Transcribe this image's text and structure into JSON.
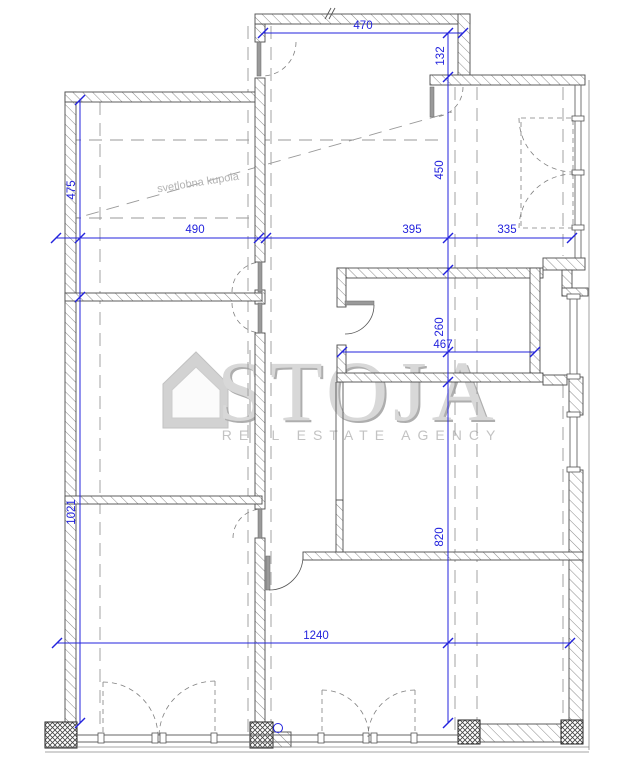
{
  "plan": {
    "type": "architectural-floor-plan",
    "skylight_label": "svetlobna kupola",
    "watermark": {
      "brand": "STOJA",
      "tagline": "REAL ESTATE AGENCY"
    },
    "dimensions": {
      "d470": "470",
      "d132": "132",
      "d475": "475",
      "d490": "490",
      "d395": "395",
      "d335": "335",
      "d450": "450",
      "d260": "260",
      "d467": "467",
      "d1021": "1021",
      "d820": "820",
      "d1240": "1240"
    },
    "colors": {
      "dimension_blue": "#2323dd",
      "wall_line": "#4d4d4d",
      "dashed_gray": "#9a9a9a",
      "watermark_gray": "#c9c9c9"
    }
  }
}
